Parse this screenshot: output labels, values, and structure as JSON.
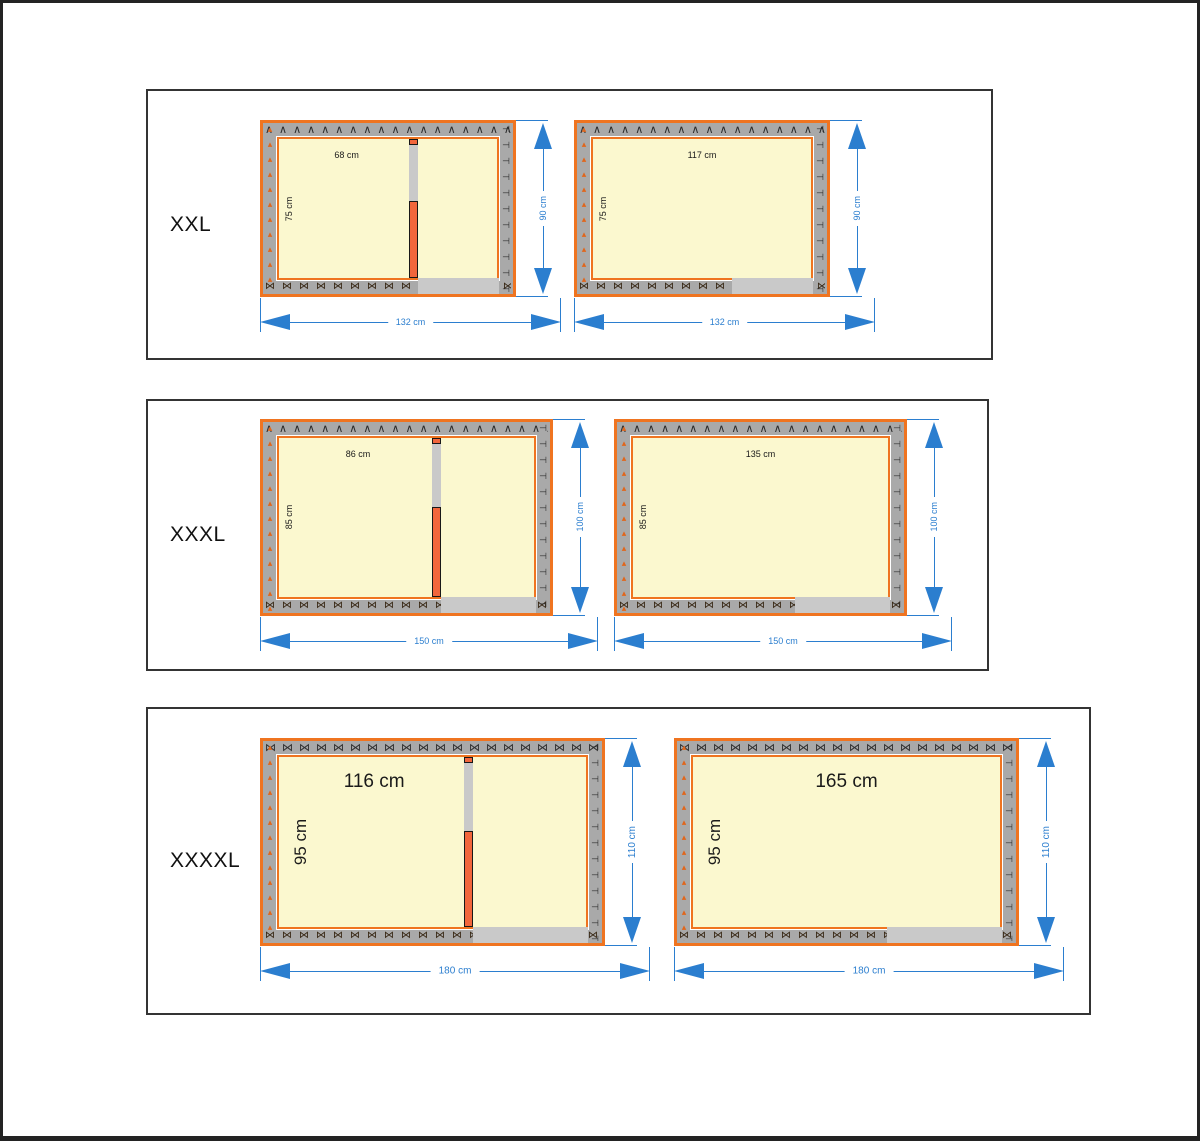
{
  "colors": {
    "frame_orange": "#ef7420",
    "divider_orange": "#f2663c",
    "wall_gray": "#a9a9a9",
    "opening_gray": "#c9c9c9",
    "interior_cream": "#fbf8cf",
    "dimension_blue": "#2b7ecf",
    "panel_border": "#343434",
    "text_black": "#1a1a1a"
  },
  "patterns": {
    "chevron": "∧∧∧∧∧∧∧∧∧∧∧∧∧∧∧∧∧∧∧∧∧∧∧∧∧∧",
    "bowtie": "⋈⋈⋈⋈⋈⋈⋈⋈⋈⋈⋈⋈⋈⋈⋈⋈⋈⋈⋈⋈⋈⋈⋈⋈⋈⋈",
    "left_triangles": "▴▴▴▴▴▴▴▴▴▴▴▴▴▴▴▴▴▴",
    "right_tees": "⊣⊣⊣⊣⊣⊣⊣⊣⊣⊣⊣⊣⊣⊣⊣⊣⊣⊣"
  },
  "panels": [
    {
      "label": "XXL",
      "figures": [
        {
          "kind": "divided",
          "room_width_label": "68 cm",
          "room_height_label": "75 cm",
          "height_dim": "90 cm",
          "width_dim": "132 cm"
        },
        {
          "kind": "open",
          "room_width_label": "117 cm",
          "room_height_label": "75 cm",
          "height_dim": "90 cm",
          "width_dim": "132 cm"
        }
      ]
    },
    {
      "label": "XXXL",
      "figures": [
        {
          "kind": "divided",
          "room_width_label": "86 cm",
          "room_height_label": "85 cm",
          "height_dim": "100 cm",
          "width_dim": "150 cm"
        },
        {
          "kind": "open",
          "room_width_label": "135 cm",
          "room_height_label": "85 cm",
          "height_dim": "100 cm",
          "width_dim": "150 cm"
        }
      ]
    },
    {
      "label": "XXXXL",
      "figures": [
        {
          "kind": "divided",
          "room_width_label": "116 cm",
          "room_height_label": "95 cm",
          "height_dim": "110 cm",
          "width_dim": "180 cm"
        },
        {
          "kind": "open",
          "room_width_label": "165 cm",
          "room_height_label": "95 cm",
          "height_dim": "110 cm",
          "width_dim": "180 cm"
        }
      ]
    }
  ]
}
